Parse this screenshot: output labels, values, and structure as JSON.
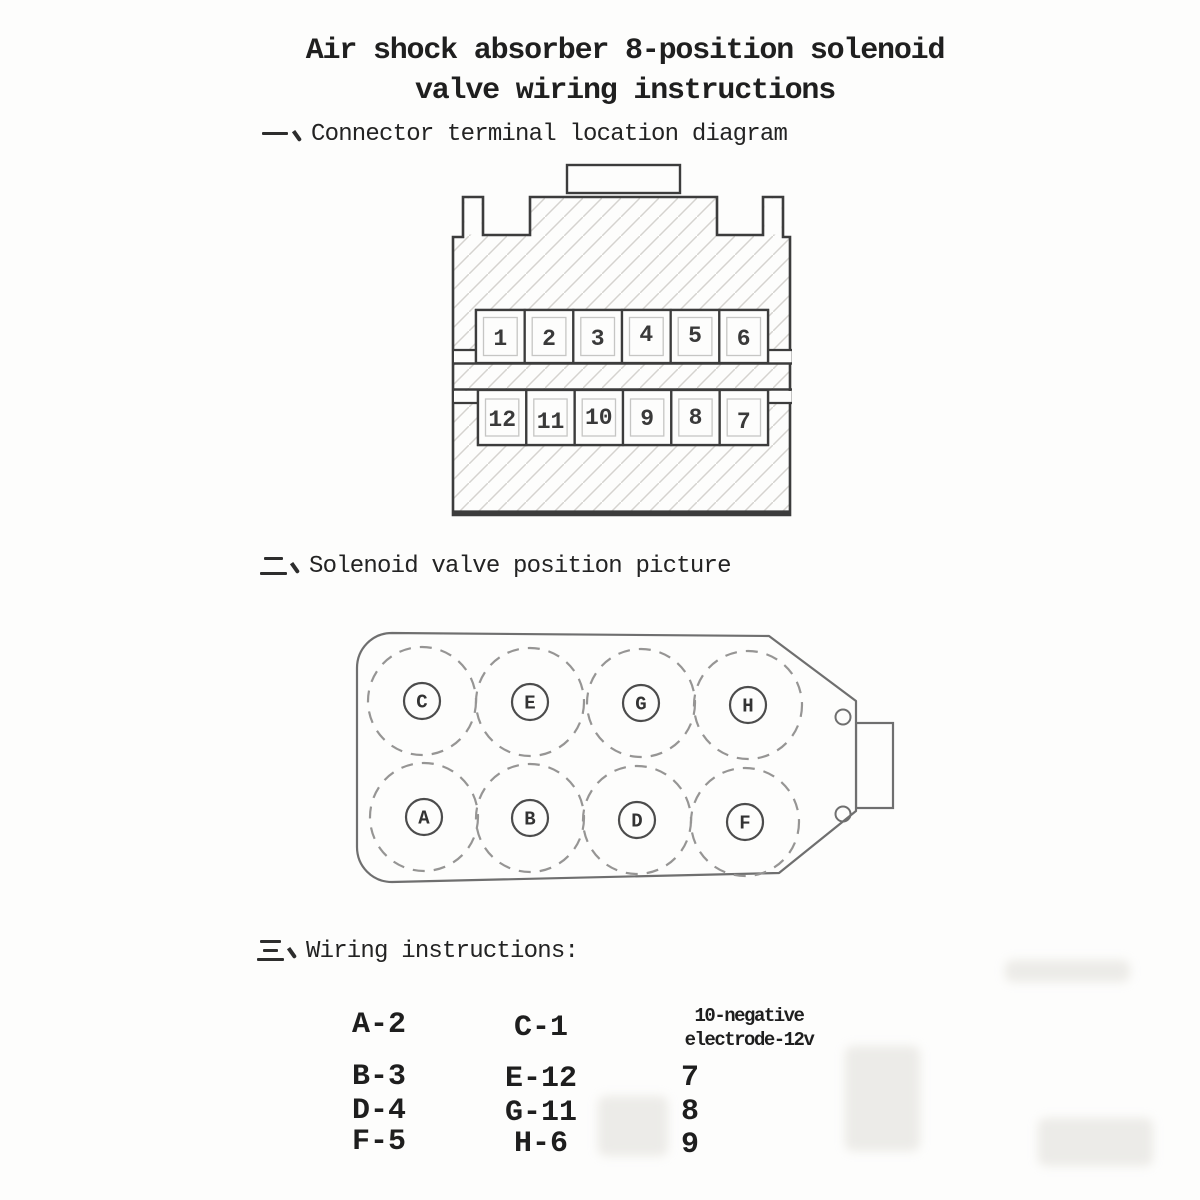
{
  "document": {
    "title_line1": "Air shock absorber 8-position solenoid",
    "title_line2": "valve wiring instructions"
  },
  "sections": [
    {
      "numeral": "一、",
      "heading": "Connector terminal location diagram"
    },
    {
      "numeral": "二、",
      "heading": "Solenoid valve position picture"
    },
    {
      "numeral": "三、",
      "heading": "Wiring instructions:"
    }
  ],
  "connector": {
    "top_row": [
      "1",
      "2",
      "3",
      "4",
      "5",
      "6"
    ],
    "bottom_row": [
      "12",
      "11",
      "10",
      "9",
      "8",
      "7"
    ]
  },
  "valve": {
    "top_row": [
      "C",
      "E",
      "G",
      "H"
    ],
    "bottom_row": [
      "A",
      "B",
      "D",
      "F"
    ]
  },
  "wiring": {
    "column1": [
      "A-2",
      "B-3",
      "D-4",
      "F-5"
    ],
    "column2": [
      "C-1",
      "E-12",
      "G-11",
      "H-6"
    ],
    "column3_header": [
      "10-negative",
      "electrode-12v"
    ],
    "column3": [
      "7",
      "8",
      "9"
    ]
  },
  "colors": {
    "paper": "#fdfdfc",
    "ink": "#262626",
    "connector_line": "#3c3c3c",
    "valve_line": "#6f6f6f",
    "hatch_line": "#d5d3cf"
  }
}
